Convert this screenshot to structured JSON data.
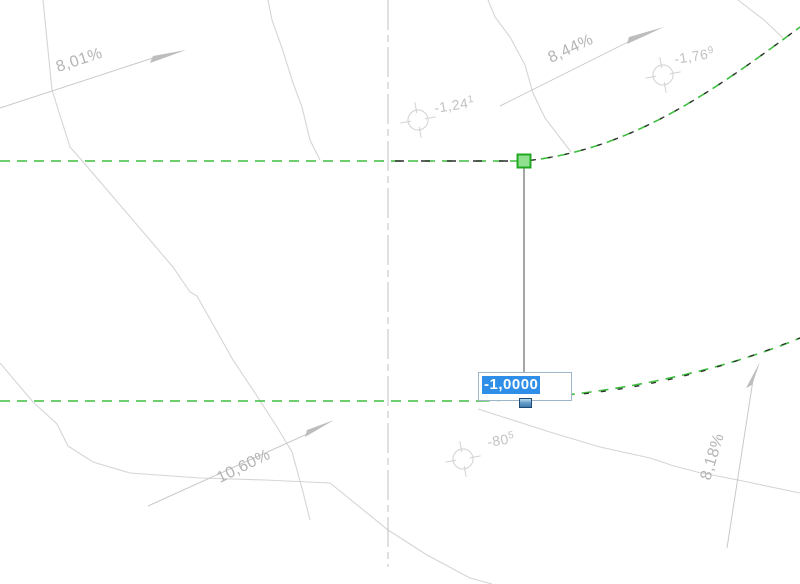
{
  "app_context": "cad-drawing-canvas",
  "canvas": {
    "width": 800,
    "height": 584,
    "background": "#ffffff"
  },
  "colors": {
    "canvas_bg": "#ffffff",
    "feature_green": "#3ebe3e",
    "selection_dash_black": "#2f2f2f",
    "contour_gray": "#d5d5d5",
    "arrow_gray": "#c9c9c9",
    "arrow_head_gray": "#bdbdbd",
    "slope_text_gray": "#b4b4b4",
    "elev_text_gray": "#c2c2c2",
    "centerline_gray": "#c0c0c0",
    "tracking_gray": "#6b6b6b",
    "grip_green_fill": "#8fe08f",
    "grip_green_border": "#21aa21",
    "grip_blue_top": "#b8dcf2",
    "grip_blue_bottom": "#3f7bb0",
    "grip_blue_border": "#1d4a73",
    "input_border": "#9fb6ca",
    "input_bg": "#ffffff",
    "selection_bg": "#2f8ee8",
    "selection_fg": "#ffffff"
  },
  "slope_labels": {
    "nw": "8,01%",
    "ne": "8,44%",
    "sw": "10,60%",
    "se": "8,18%"
  },
  "elevation_labels": {
    "top_center": {
      "base": "-1,24",
      "sup": "1"
    },
    "top_right": {
      "base": "-1,76",
      "sup": "9"
    },
    "bottom_center": {
      "base": "-80",
      "sup": "5"
    }
  },
  "elevation_input": {
    "value": "-1,0000"
  }
}
